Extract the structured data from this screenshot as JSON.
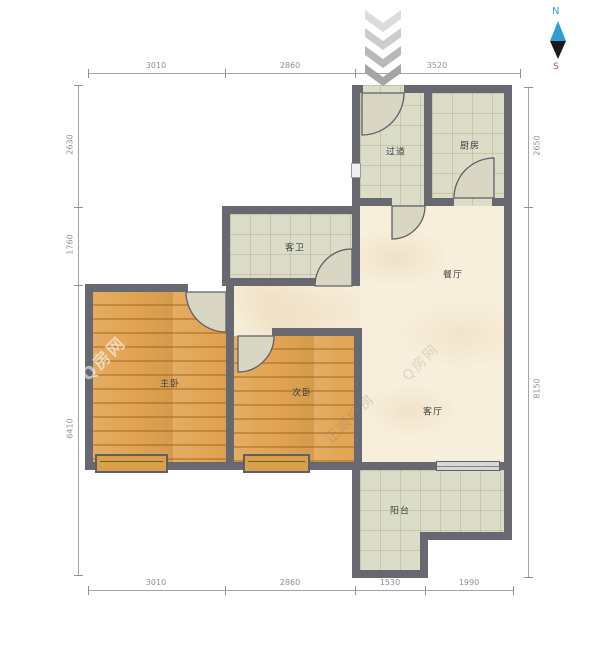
{
  "rooms": {
    "hallway": "过道",
    "kitchen": "厨房",
    "guest_bathroom": "客卫",
    "dining_room": "餐厅",
    "master_bedroom": "主卧",
    "second_bedroom": "次卧",
    "living_room": "客厅",
    "balcony": "阳台"
  },
  "dims": {
    "top": [
      "3010",
      "2860",
      "3520"
    ],
    "bottom": [
      "3010",
      "2860",
      "1530",
      "1990"
    ],
    "left": [
      "2630",
      "1760",
      "6410"
    ],
    "right": [
      "2650",
      "8150"
    ]
  },
  "compass": {
    "north_label": "N",
    "south_label": "S"
  },
  "watermarks": {
    "brand": "Q房网",
    "agency": "正顺好房"
  },
  "colors": {
    "wall": "#686871",
    "tile_floor": "#dcddc8",
    "wood_floor": "#e1a452",
    "marble_floor": "#f7efdc",
    "door_leaf": "#d9d6c3",
    "window_bay": "#d9a04b",
    "compass_north": "#2e9fd4",
    "compass_south": "#b4524a",
    "dimension_text": "#8f8f99"
  }
}
